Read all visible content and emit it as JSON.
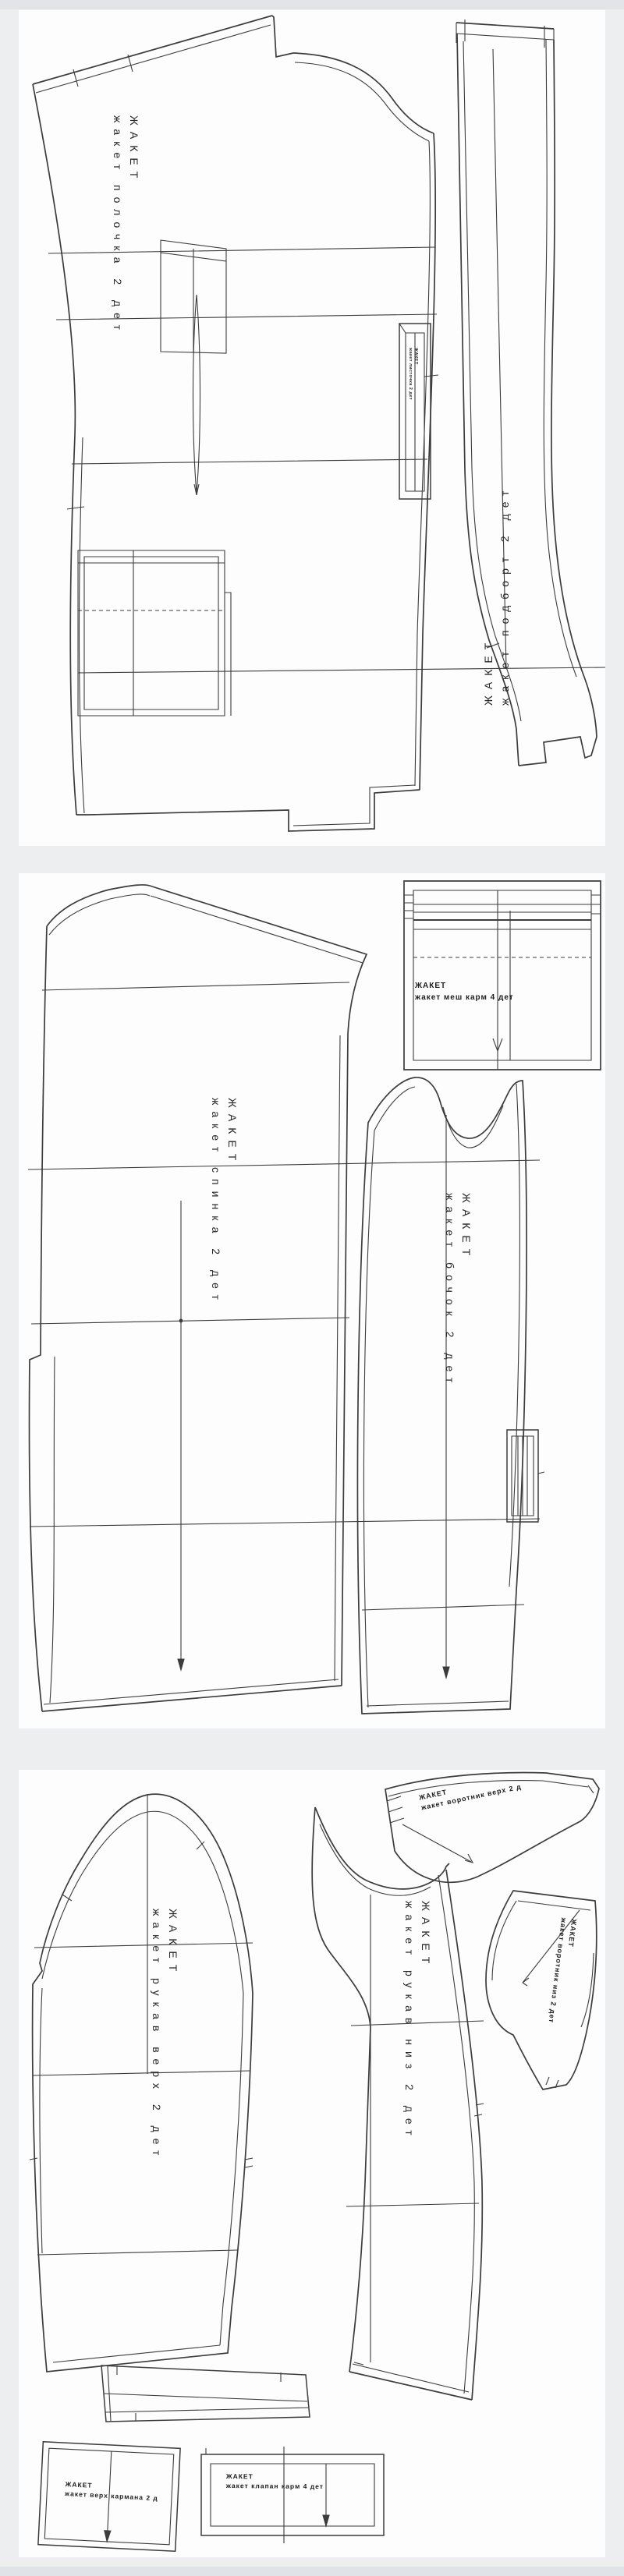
{
  "colors": {
    "page_background": "#edeef0",
    "panel_background": "#fdfdfd",
    "line_color": "#3c3c3c",
    "text_color": "#262626"
  },
  "pieces": {
    "polochka": {
      "line1": "ЖАКЕТ",
      "line2": "жакет полочка 2 дет"
    },
    "podbort": {
      "line1": "ЖАКЕТ",
      "line2": "жакет подборт 2 дет"
    },
    "listochka": {
      "line1": "ЖАКЕТ",
      "line2": "жакет листочка 2 дет"
    },
    "spinka": {
      "line1": "ЖАКЕТ",
      "line2": "жакет спинка 2 дет"
    },
    "bochok": {
      "line1": "ЖАКЕТ",
      "line2": "жакет бочок 2 дет"
    },
    "mesh_karm": {
      "line1": "ЖАКЕТ",
      "line2": "жакет меш карм 4 дет"
    },
    "rukav_verh": {
      "line1": "ЖАКЕТ",
      "line2": "жакет рукав верх 2 дет"
    },
    "rukav_niz": {
      "line1": "ЖАКЕТ",
      "line2": "жакет рукав низ 2 дет"
    },
    "vorotnik_verh": {
      "line1": "ЖАКЕТ",
      "line2": "жакет воротник верх 2 д"
    },
    "vorotnik_niz": {
      "line1": "ЖАКЕТ",
      "line2": "жакет воротник низ 2 дет"
    },
    "verh_karmana": {
      "line1": "ЖАКЕТ",
      "line2": "жакет верх кармана 2 д"
    },
    "klapan": {
      "line1": "ЖАКЕТ",
      "line2": "жакет клапан карм 4 дет"
    }
  }
}
